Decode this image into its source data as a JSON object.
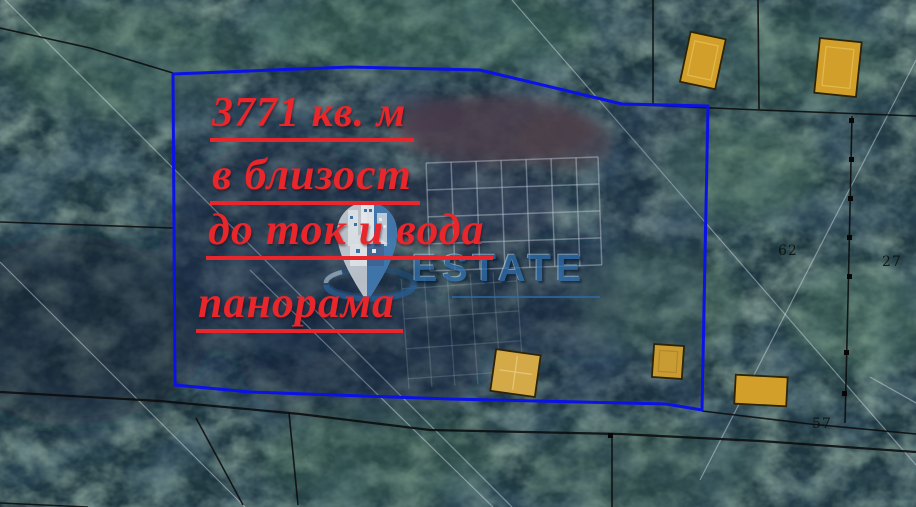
{
  "map": {
    "type": "satellite-parcel-view",
    "boundary_color": "#0a12e6",
    "building_color": "#d2a02a",
    "parcel_labels": [
      {
        "text": "62"
      },
      {
        "text": "27"
      },
      {
        "text": "57"
      }
    ]
  },
  "annotations": {
    "color": "#e8262b",
    "lines": [
      {
        "text": "3771 кв. м"
      },
      {
        "text": "в близост"
      },
      {
        "text": "до ток и вода"
      },
      {
        "text": "панорама"
      }
    ]
  },
  "watermark": {
    "brand": "ESTATE",
    "color": "#2d6dab",
    "icon": "location-pin-buildings"
  }
}
